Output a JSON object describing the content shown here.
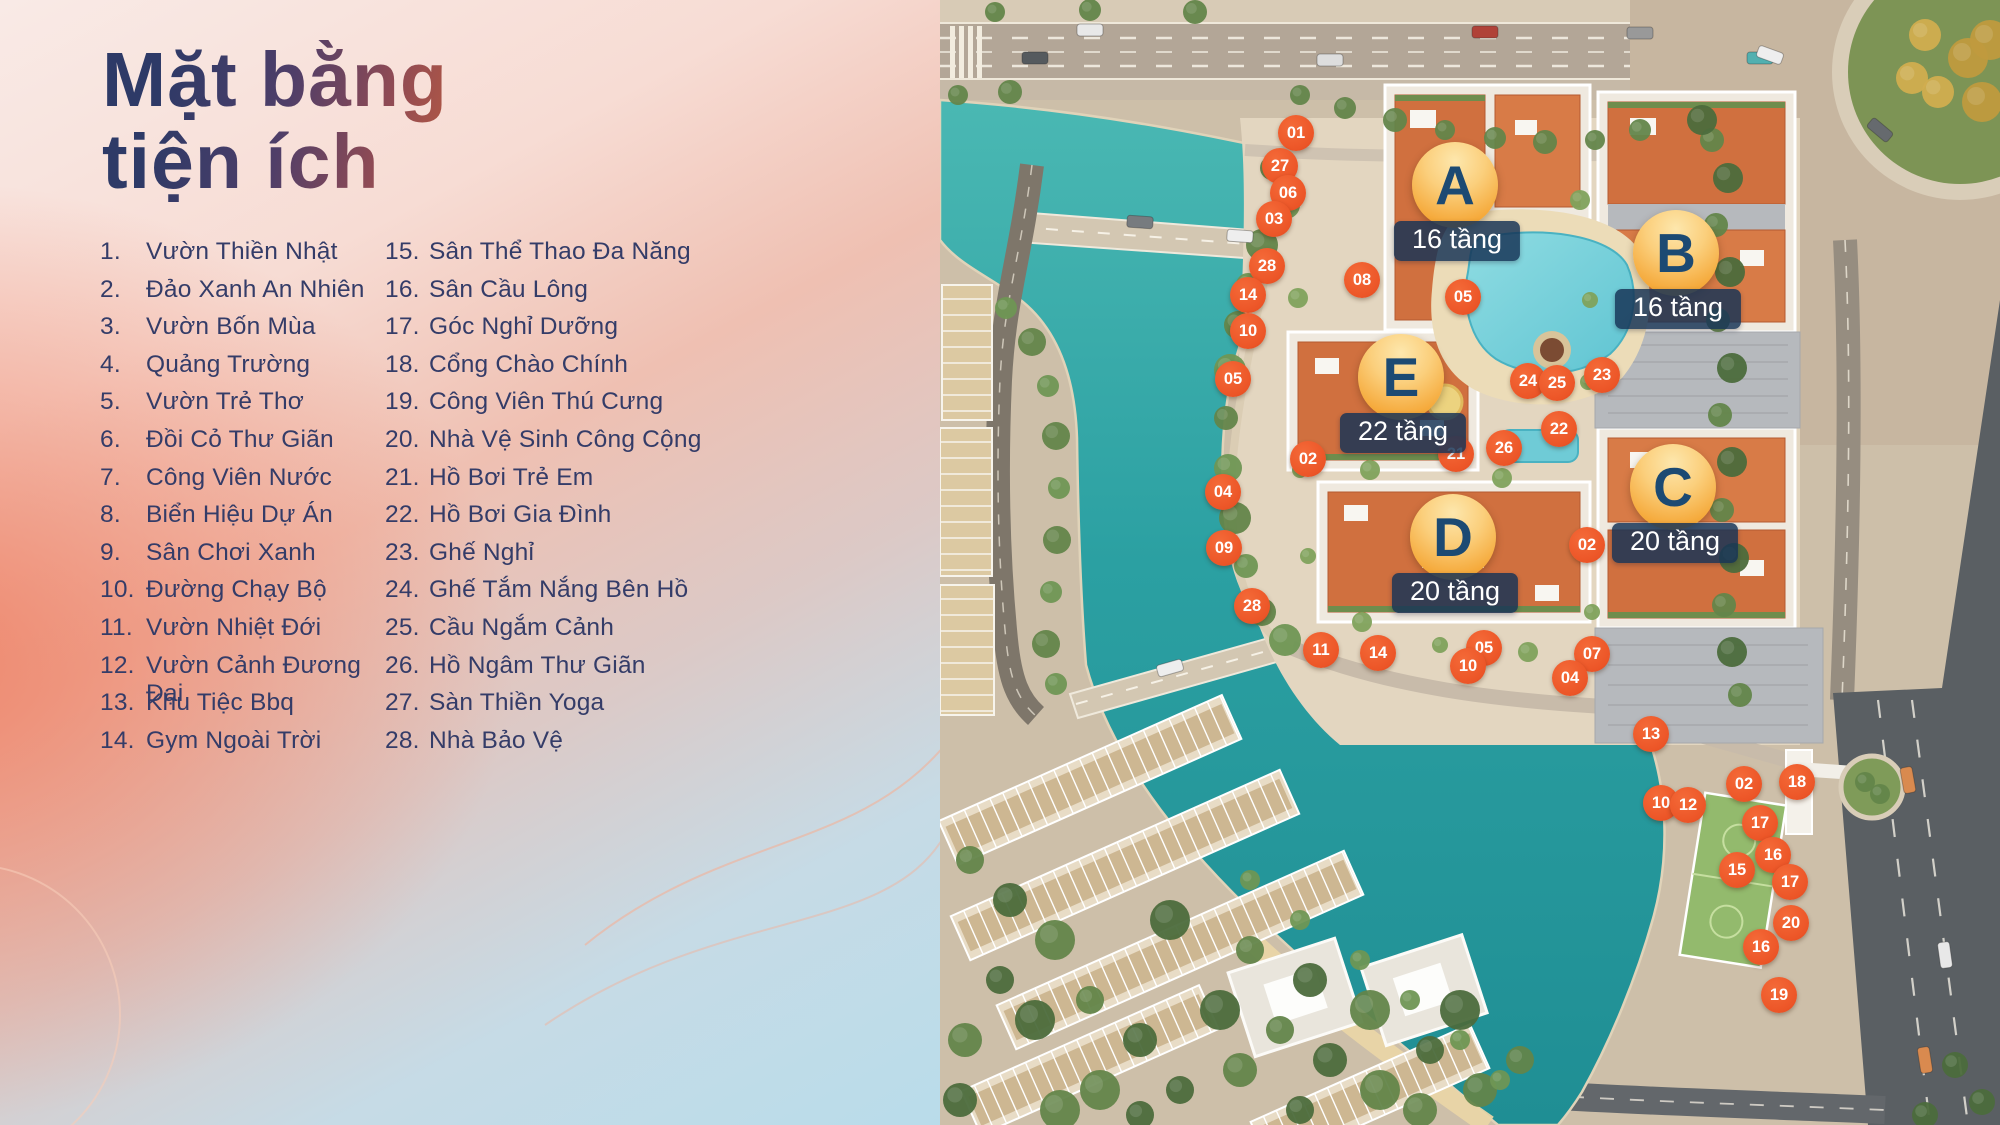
{
  "title": {
    "line1": "Mặt bằng",
    "line2": "tiện ích"
  },
  "legend": {
    "col1_start": 1,
    "col2_start": 15,
    "col1": [
      "Vườn Thiền Nhật",
      "Đảo Xanh An Nhiên",
      "Vườn Bốn Mùa",
      "Quảng Trường",
      "Vườn Trẻ Thơ",
      "Đồi Cỏ Thư Giãn",
      "Công Viên Nước",
      "Biển Hiệu Dự Án",
      "Sân Chơi Xanh",
      "Đường Chạy Bộ",
      "Vườn Nhiệt Đới",
      "Vườn Cảnh Đương Đại",
      "Khu Tiệc Bbq",
      "Gym Ngoài Trời"
    ],
    "col2": [
      "Sân Thể Thao Đa Năng",
      "Sân Cầu Lông",
      "Góc Nghỉ Dưỡng",
      "Cổng Chào Chính",
      "Công Viên Thú Cưng",
      "Nhà Vệ Sinh Công Cộng",
      "Hồ Bơi Trẻ Em",
      "Hồ Bơi Gia Đình",
      "Ghế Nghỉ",
      "Ghế Tắm Nắng Bên Hồ",
      "Cầu Ngắm Cảnh",
      "Hồ Ngâm Thư Giãn",
      "Sàn Thiền Yoga",
      "Nhà Bảo Vệ"
    ]
  },
  "map": {
    "building_badges": [
      {
        "letter": "A",
        "floors": "16 tầng",
        "x": 1455,
        "y": 185
      },
      {
        "letter": "B",
        "floors": "16 tầng",
        "x": 1676,
        "y": 253
      },
      {
        "letter": "E",
        "floors": "22 tầng",
        "x": 1401,
        "y": 377
      },
      {
        "letter": "C",
        "floors": "20 tầng",
        "x": 1673,
        "y": 487
      },
      {
        "letter": "D",
        "floors": "20 tầng",
        "x": 1453,
        "y": 537
      }
    ],
    "markers": [
      {
        "num": "01",
        "x": 1296,
        "y": 133
      },
      {
        "num": "27",
        "x": 1280,
        "y": 166
      },
      {
        "num": "06",
        "x": 1288,
        "y": 193
      },
      {
        "num": "03",
        "x": 1274,
        "y": 219
      },
      {
        "num": "28",
        "x": 1267,
        "y": 266
      },
      {
        "num": "14",
        "x": 1248,
        "y": 295
      },
      {
        "num": "10",
        "x": 1248,
        "y": 331
      },
      {
        "num": "05",
        "x": 1233,
        "y": 379
      },
      {
        "num": "08",
        "x": 1362,
        "y": 280
      },
      {
        "num": "05",
        "x": 1463,
        "y": 297
      },
      {
        "num": "24",
        "x": 1528,
        "y": 381
      },
      {
        "num": "25",
        "x": 1557,
        "y": 383
      },
      {
        "num": "23",
        "x": 1602,
        "y": 375
      },
      {
        "num": "22",
        "x": 1559,
        "y": 429
      },
      {
        "num": "21",
        "x": 1456,
        "y": 454
      },
      {
        "num": "26",
        "x": 1504,
        "y": 448
      },
      {
        "num": "02",
        "x": 1308,
        "y": 459
      },
      {
        "num": "04",
        "x": 1223,
        "y": 492
      },
      {
        "num": "09",
        "x": 1224,
        "y": 548
      },
      {
        "num": "28",
        "x": 1252,
        "y": 606
      },
      {
        "num": "02",
        "x": 1587,
        "y": 545
      },
      {
        "num": "11",
        "x": 1321,
        "y": 650
      },
      {
        "num": "14",
        "x": 1378,
        "y": 653
      },
      {
        "num": "05",
        "x": 1484,
        "y": 648
      },
      {
        "num": "10",
        "x": 1468,
        "y": 666
      },
      {
        "num": "07",
        "x": 1592,
        "y": 654
      },
      {
        "num": "04",
        "x": 1570,
        "y": 678
      },
      {
        "num": "13",
        "x": 1651,
        "y": 734
      },
      {
        "num": "10",
        "x": 1661,
        "y": 803
      },
      {
        "num": "12",
        "x": 1688,
        "y": 805
      },
      {
        "num": "02",
        "x": 1744,
        "y": 784
      },
      {
        "num": "18",
        "x": 1797,
        "y": 782
      },
      {
        "num": "17",
        "x": 1760,
        "y": 823
      },
      {
        "num": "16",
        "x": 1773,
        "y": 855
      },
      {
        "num": "15",
        "x": 1737,
        "y": 870
      },
      {
        "num": "17",
        "x": 1790,
        "y": 882
      },
      {
        "num": "20",
        "x": 1791,
        "y": 923
      },
      {
        "num": "16",
        "x": 1761,
        "y": 947
      },
      {
        "num": "19",
        "x": 1779,
        "y": 995
      }
    ]
  },
  "colors": {
    "marker_orange": "#ec5527",
    "badge_letter_navy": "#1c4a73",
    "pill_navy": "rgba(23,51,86,0.84)",
    "water_teal": "#2ba0a2",
    "accent_coral": "#ee8064",
    "accent_blue": "#b9dcea",
    "text_navy": "#343c68"
  }
}
